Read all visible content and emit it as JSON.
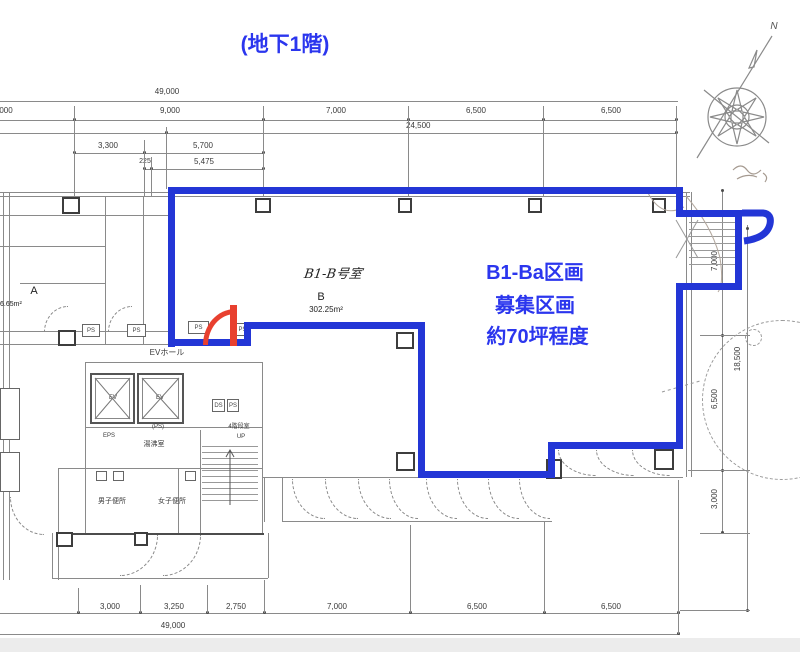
{
  "page": {
    "title": "(地下1階)"
  },
  "callout": {
    "line1": "B1-Ba区画",
    "line2": "募集区画",
    "line3": "約70坪程度"
  },
  "room_b": {
    "handwritten": "B1-B号室",
    "letter": "B",
    "area": "302.25m²"
  },
  "room_a": {
    "letter": "A",
    "area": "6.65m²"
  },
  "core": {
    "ev_hall": "EVホール",
    "ev1": "EV",
    "ev2": "EV",
    "eps": "EPS",
    "ps_paren": "(PS)",
    "kitchenette": "湯沸室",
    "mens_wc": "男子便所",
    "womens_wc": "女子便所",
    "stair": "4階段室",
    "up": "UP",
    "ds_box": "DS",
    "ps_box_small": "PS",
    "ps_boxes": [
      "PS",
      "PS",
      "PS",
      "PS"
    ]
  },
  "compass": {
    "north": "N"
  },
  "dims": {
    "top_overall": "49,000",
    "top_row2": [
      "000",
      "9,000",
      "7,000",
      "6,500",
      "6,500"
    ],
    "top_row3": "24,500",
    "top_row4": [
      "3,300",
      "5,700"
    ],
    "top_row5": [
      "225",
      "5,475"
    ],
    "bottom_row": [
      "3,000",
      "3,250",
      "2,750",
      "7,000",
      "6,500",
      "6,500"
    ],
    "bottom_overall": "49,000",
    "right_inner": [
      "7,000",
      "6,500",
      "3,000"
    ],
    "right_overall": "18,500"
  },
  "colors": {
    "boundary_blue": "#2336d6",
    "text_blue": "#2b36ee",
    "door_red": "#e8402f"
  }
}
